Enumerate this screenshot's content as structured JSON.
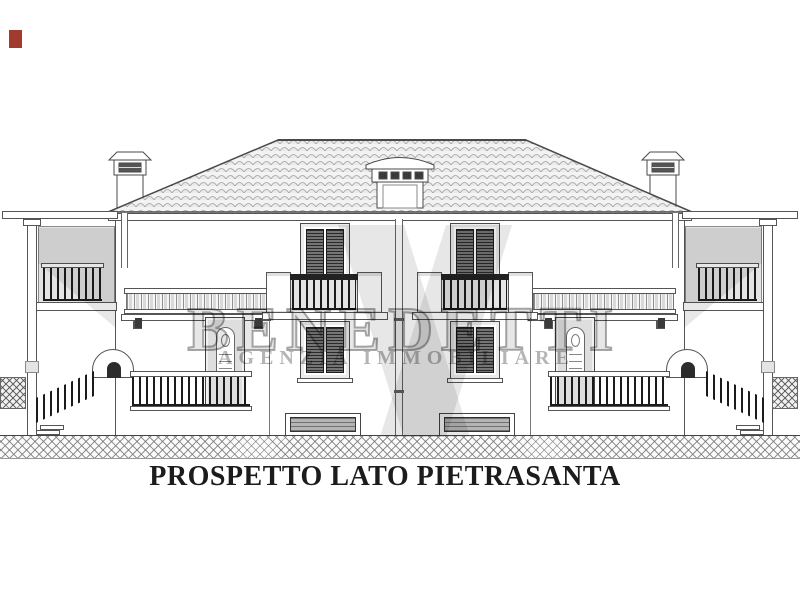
{
  "drawing": {
    "caption": "PROSPETTO LATO PIETRASANTA"
  },
  "watermark": {
    "name": "BENEDETTI",
    "subtitle": "AGENZIA IMMOBILIARE"
  },
  "colors": {
    "paper": "#ffffff",
    "ink": "#4a4a4a",
    "dark_fill": "#1b1b1b",
    "wall_shade": "#e4e4e4",
    "watermark_grey": "#8f8f8f",
    "corner_mark_red": "#a23b2e"
  }
}
